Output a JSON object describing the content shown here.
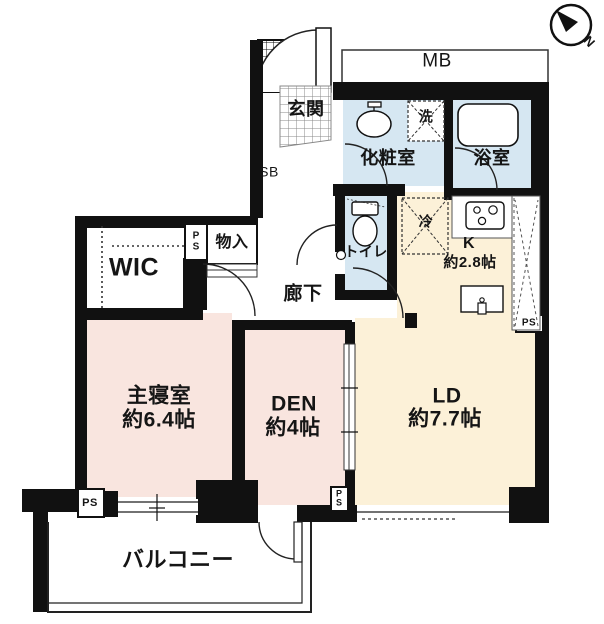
{
  "title": "apartment-floor-plan",
  "compass": {
    "north_label": "N"
  },
  "labels": {
    "mb": "MB",
    "genkan": "玄関",
    "sb": "SB",
    "powder_room": "化粧室",
    "washer": "洗",
    "bathroom": "浴室",
    "toilet": "トイレ",
    "fridge": "冷",
    "kitchen_name": "K",
    "kitchen_size": "約2.8帖",
    "hallway": "廊下",
    "wic": "WIC",
    "closet": "物入",
    "ps": "PS",
    "bedroom_name": "主寝室",
    "bedroom_size": "約6.4帖",
    "den_name": "DEN",
    "den_size": "約4帖",
    "ld_name": "LD",
    "ld_size": "約7.7帖",
    "balcony": "バルコニー"
  },
  "colors": {
    "wall": "#111111",
    "bedroom_pink": "#f9e5df",
    "living_cream": "#fcf1d8",
    "sanitary_blue": "#d6e7f2",
    "thin_line": "#333333"
  }
}
